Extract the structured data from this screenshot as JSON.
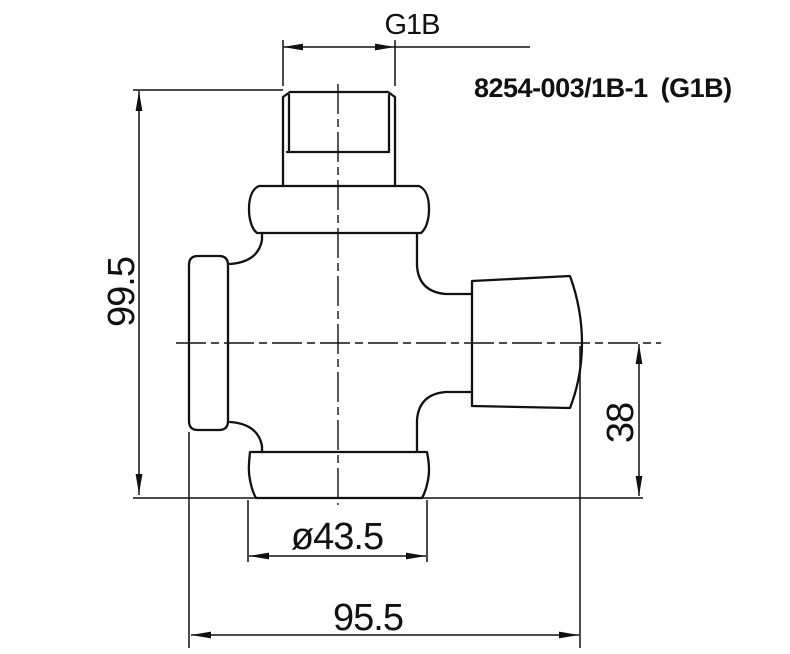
{
  "drawing": {
    "part_number": "8254-003/1B-1 (G1B)",
    "dimensions": {
      "thread_size": "G1B",
      "overall_height": "99.5",
      "overall_width": "95.5",
      "nut_diameter": "ø43.5",
      "outlet_offset": "38"
    },
    "colors": {
      "line": "#111111",
      "background": "#ffffff"
    }
  }
}
